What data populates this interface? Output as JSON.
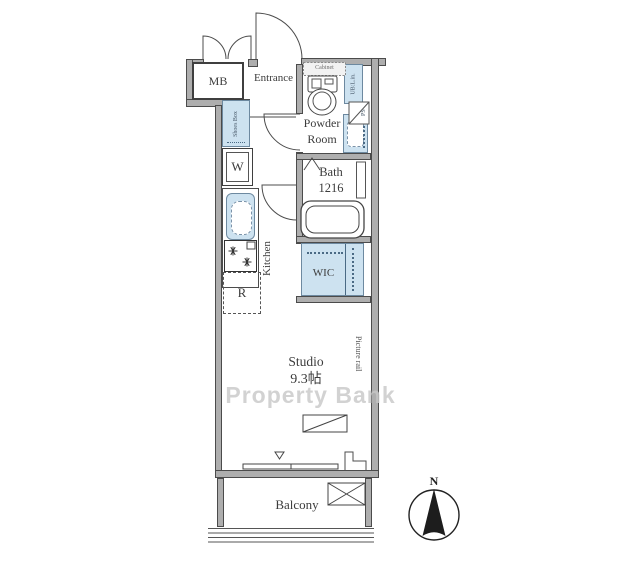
{
  "floorplan": {
    "labels": {
      "mb": "MB",
      "entrance": "Entrance",
      "cabinet": "Cabinet",
      "ub_linen": "UB:L.in.",
      "ps": "PS",
      "powder_room": [
        "Powder",
        "Room"
      ],
      "shoes_box": "Shoes Box",
      "washing_machine": "W",
      "kitchen": "Kitchen",
      "bath": [
        "Bath",
        "1216"
      ],
      "refrigerator": "R",
      "wic": "WIC",
      "studio": [
        "Studio",
        "9.3帖"
      ],
      "picture_rail": "Picture rail",
      "balcony": "Balcony"
    },
    "compass": {
      "north": "N"
    },
    "watermark": "Property Bank",
    "colors": {
      "wall_fill": "#aeaeae",
      "wall_edge": "#4b4b4b",
      "fixture_fill": "#cde2f0",
      "fixture_edge": "#6d89a0",
      "line": "#4c4c4c",
      "text": "#3c3c3c",
      "watermark": "#c8c8c8"
    }
  }
}
